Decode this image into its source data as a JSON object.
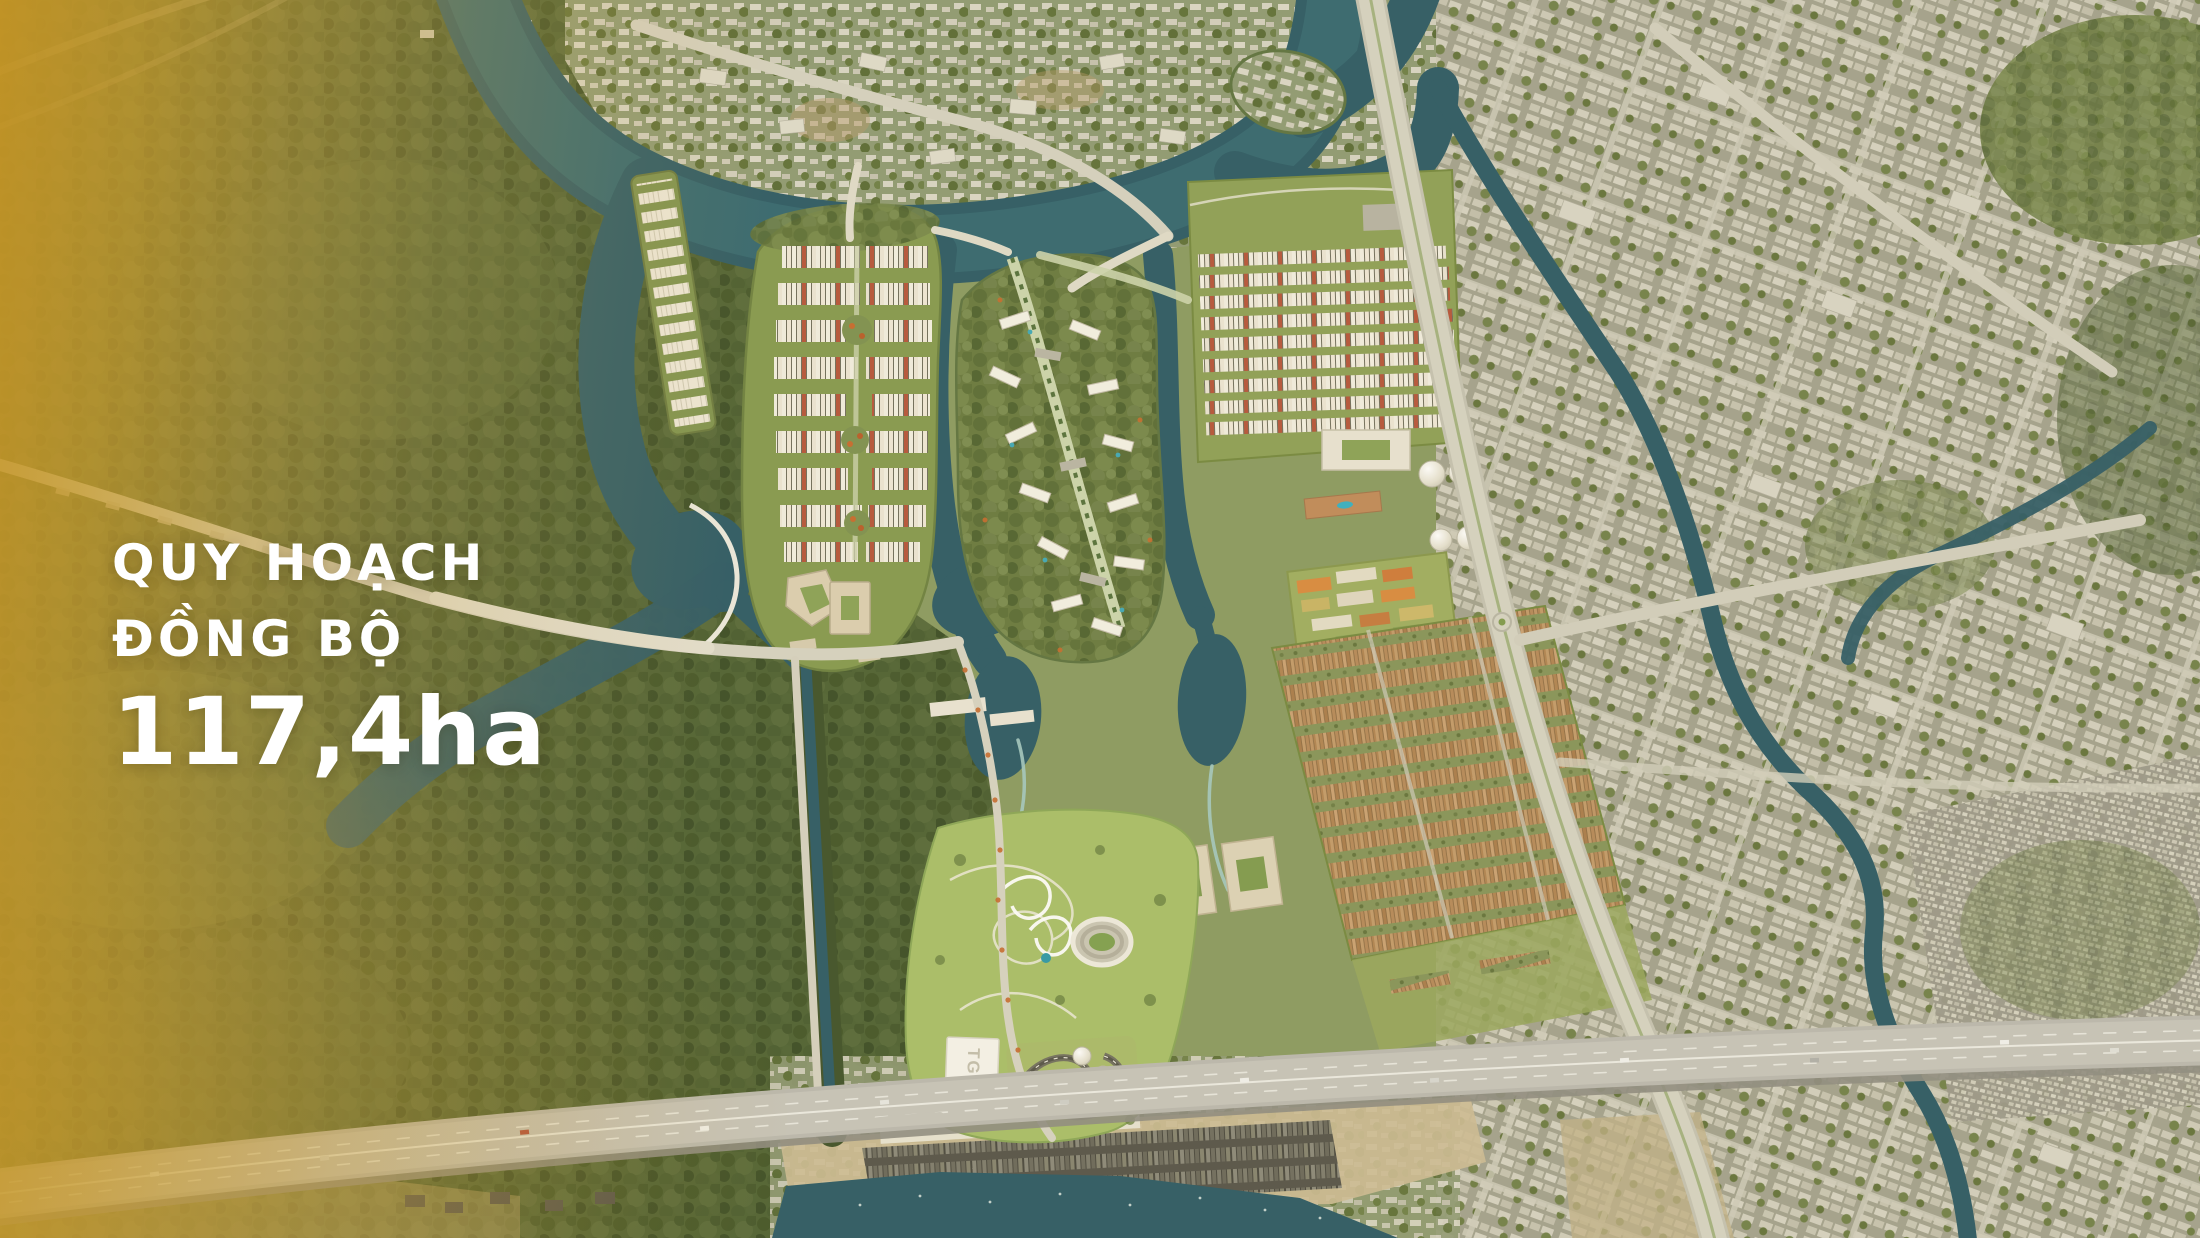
{
  "overlay": {
    "line1": "QUY HOẠCH",
    "line2": "ĐỒNG BỘ",
    "area_value": "117,4ha"
  },
  "map_labels": {
    "tgc_building": "TGC"
  },
  "palette": {
    "overlay_text": "#ffffff",
    "gold_accent": "#c59a33",
    "water": "#2c5a66",
    "water_light": "#3a6d75",
    "forest_dark": "#4e6133",
    "forest_mid": "#68793f",
    "parkland": "#a8bf69",
    "road_light": "#d7d3c3",
    "highway_grey": "#bbb9b0",
    "roof_white": "#f2eee1",
    "roof_red": "#b5543b",
    "roof_brown": "#b08452",
    "sand": "#cdbc96"
  }
}
